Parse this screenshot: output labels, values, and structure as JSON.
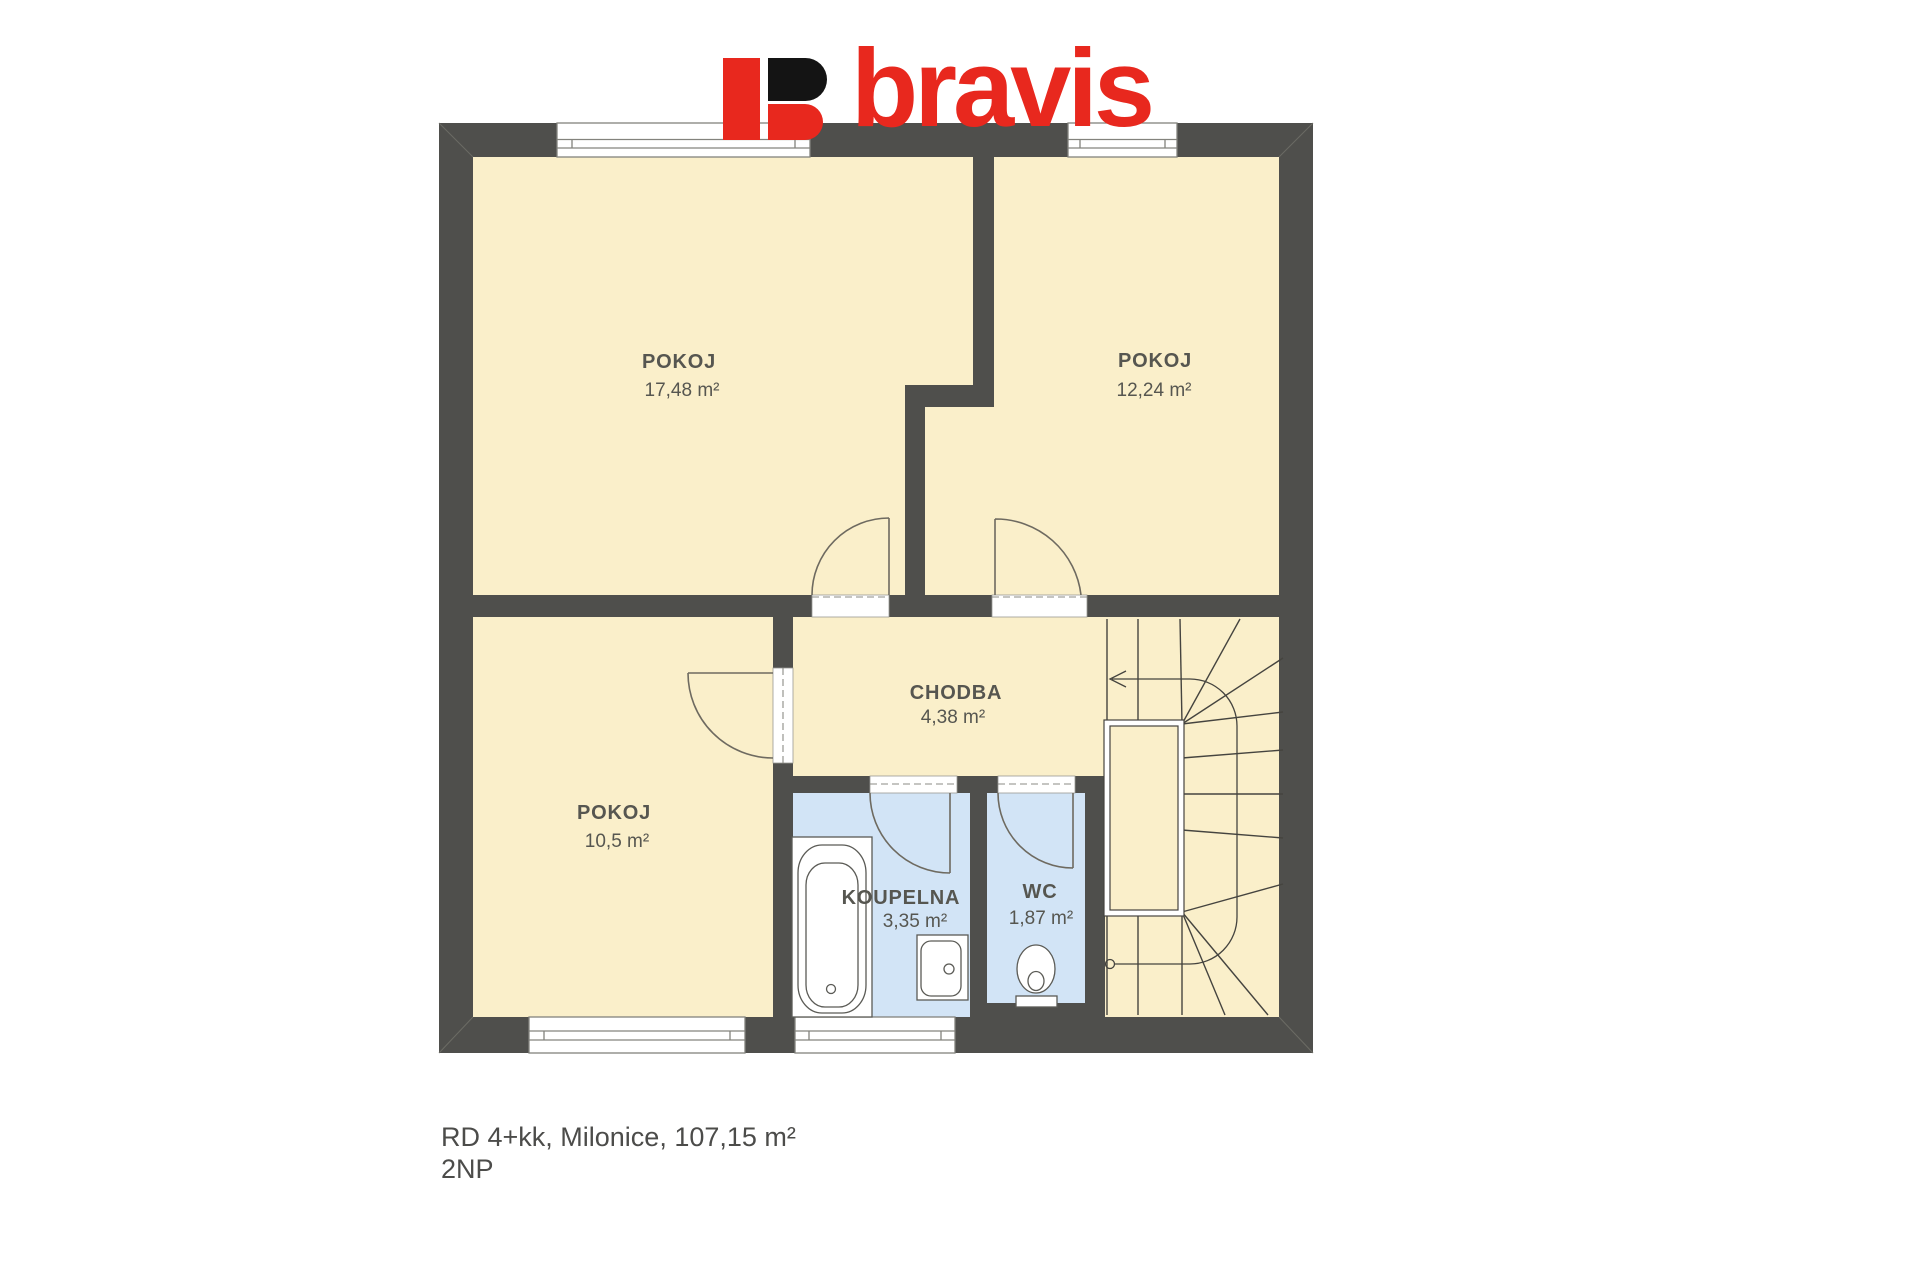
{
  "logo": {
    "text": "bravis",
    "red": "#e8281e",
    "black": "#141414"
  },
  "rooms": [
    {
      "name": "POKOJ",
      "area": "17,48 m²"
    },
    {
      "name": "POKOJ",
      "area": "12,24 m²"
    },
    {
      "name": "POKOJ",
      "area": "10,5 m²"
    },
    {
      "name": "CHODBA",
      "area": "4,38 m²"
    },
    {
      "name": "KOUPELNA",
      "area": "3,35 m²"
    },
    {
      "name": "WC",
      "area": "1,87 m²"
    }
  ],
  "caption": {
    "line1": "RD 4+kk, Milonice, 107,15 m²",
    "line2": "2NP"
  },
  "colors": {
    "wall": "#4f4f4c",
    "floor": "#faefca",
    "wet_room": "#d2e4f6",
    "line": "#45443f",
    "label": "#565650",
    "logo_red": "#e8281e"
  }
}
